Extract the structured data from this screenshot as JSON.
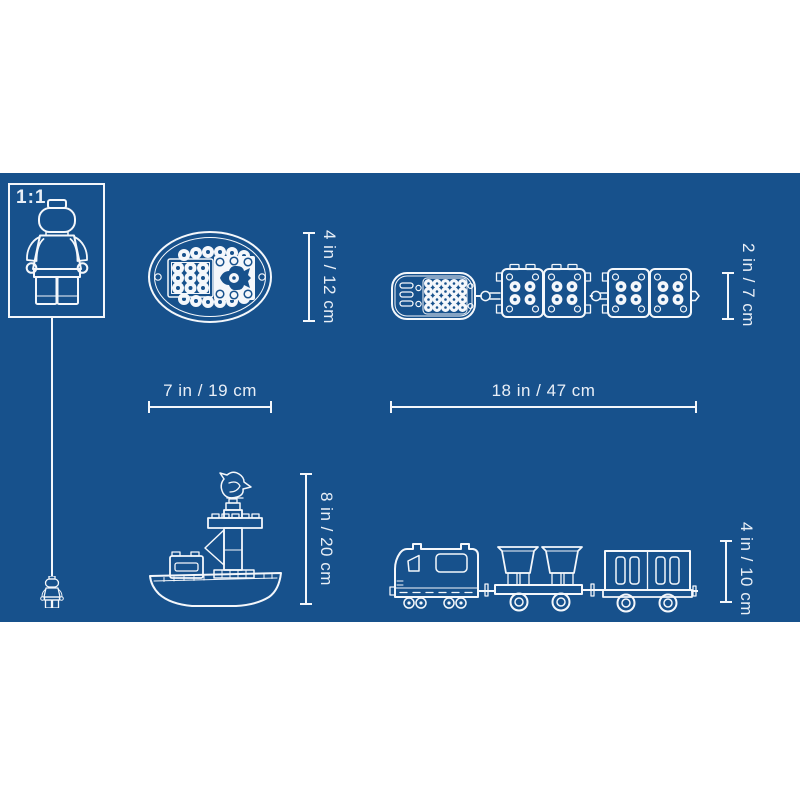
{
  "colors": {
    "page": "#ffffff",
    "blueprint": "#17518c",
    "line": "#f4f7fb",
    "text": "#e9eff7"
  },
  "scale_box": {
    "label": "1:1"
  },
  "measurements": {
    "boat_top": {
      "height": "4 in / 12 cm",
      "width": "7 in / 19 cm"
    },
    "train_top": {
      "height": "2 in / 7 cm",
      "width": "18 in / 47 cm"
    },
    "boat_side": {
      "height": "8 in / 20 cm"
    },
    "train_side": {
      "height": "4 in / 10 cm"
    }
  },
  "icons": {
    "scale_figure": "minifigure-outline-icon",
    "scale_marker": "mini-minifigure-icon",
    "boat_top": "boat-top-view-icon",
    "train_top": "train-top-view-icon",
    "boat_side": "boat-side-view-icon",
    "train_side": "train-side-view-icon"
  }
}
